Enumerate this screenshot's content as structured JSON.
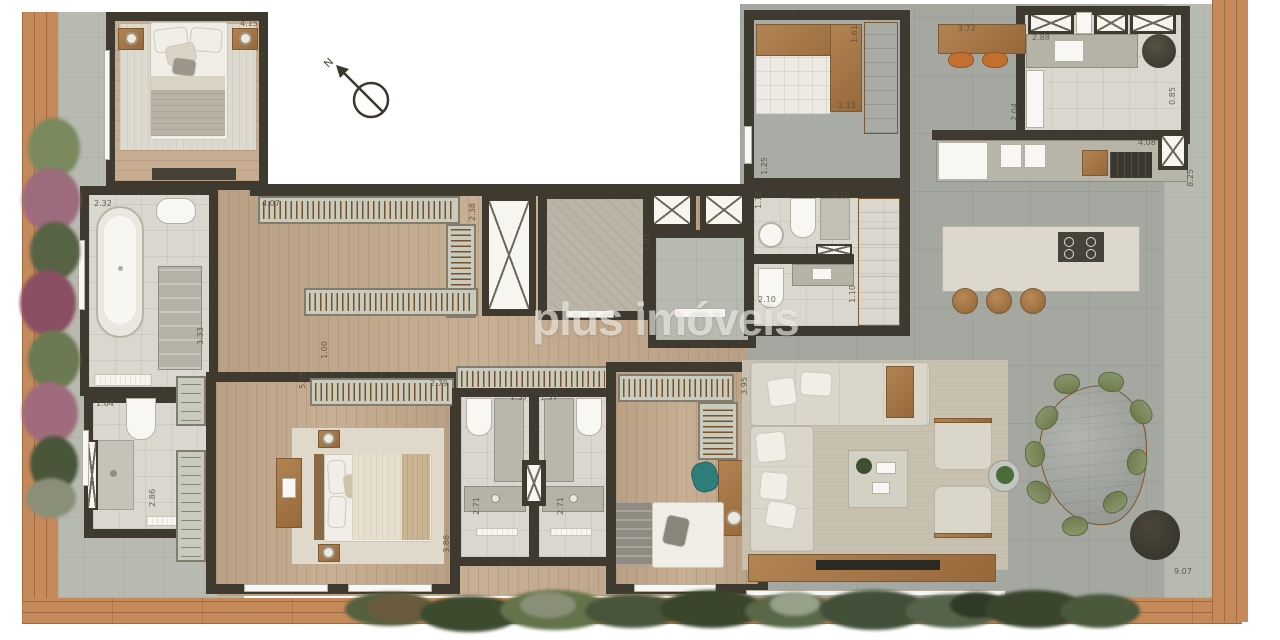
{
  "watermark": {
    "text": "plus imóveis"
  },
  "compass": {
    "label": "N"
  },
  "palette": {
    "wall": "#3f3a2f",
    "deck_wood": "#c5895a",
    "floor_wood": "#c3a98c",
    "floor_concrete": "#a4a8a1",
    "bath_tile": "#dad7ce",
    "cabinet": "#c9cbbd",
    "furniture_wood": "#a87c4e",
    "upholstery": "#dad6ca",
    "dining_chair_green": "#7d8d5b",
    "desk_chair_teal": "#2e7f7c",
    "stool_orange": "#c2702f",
    "watermark_white": "#f8f7f2"
  },
  "dimension_labels": [
    {
      "text": "4.15",
      "x": 240,
      "y": 20,
      "vertical": false
    },
    {
      "text": "2.32",
      "x": 94,
      "y": 200,
      "vertical": false
    },
    {
      "text": "3.33",
      "x": 192,
      "y": 332,
      "vertical": true
    },
    {
      "text": "1.64",
      "x": 96,
      "y": 400,
      "vertical": false
    },
    {
      "text": "2.86",
      "x": 144,
      "y": 494,
      "vertical": true
    },
    {
      "text": "4.07",
      "x": 262,
      "y": 200,
      "vertical": false
    },
    {
      "text": "2.38",
      "x": 464,
      "y": 208,
      "vertical": true
    },
    {
      "text": "1.00",
      "x": 316,
      "y": 346,
      "vertical": true
    },
    {
      "text": "5.95",
      "x": 294,
      "y": 376,
      "vertical": true
    },
    {
      "text": "2.79",
      "x": 430,
      "y": 380,
      "vertical": false
    },
    {
      "text": "3.86",
      "x": 438,
      "y": 540,
      "vertical": true
    },
    {
      "text": "1.37",
      "x": 510,
      "y": 394,
      "vertical": false
    },
    {
      "text": "1.37",
      "x": 540,
      "y": 394,
      "vertical": false
    },
    {
      "text": "2.71",
      "x": 468,
      "y": 502,
      "vertical": true
    },
    {
      "text": "2.71",
      "x": 552,
      "y": 502,
      "vertical": true
    },
    {
      "text": "3.95",
      "x": 736,
      "y": 382,
      "vertical": true
    },
    {
      "text": "1.81",
      "x": 638,
      "y": 238,
      "vertical": true
    },
    {
      "text": "1.12",
      "x": 750,
      "y": 196,
      "vertical": true
    },
    {
      "text": "2.10",
      "x": 832,
      "y": 192,
      "vertical": false
    },
    {
      "text": "2.10",
      "x": 758,
      "y": 296,
      "vertical": false
    },
    {
      "text": "1.10",
      "x": 844,
      "y": 290,
      "vertical": true
    },
    {
      "text": "1.61",
      "x": 846,
      "y": 30,
      "vertical": true
    },
    {
      "text": "2.13",
      "x": 838,
      "y": 102,
      "vertical": false
    },
    {
      "text": "1.25",
      "x": 756,
      "y": 162,
      "vertical": true
    },
    {
      "text": "3.72",
      "x": 958,
      "y": 25,
      "vertical": false
    },
    {
      "text": "2.88",
      "x": 1032,
      "y": 34,
      "vertical": false
    },
    {
      "text": "2.04",
      "x": 1006,
      "y": 108,
      "vertical": true
    },
    {
      "text": "0.85",
      "x": 1164,
      "y": 92,
      "vertical": true
    },
    {
      "text": "4.08",
      "x": 1138,
      "y": 139,
      "vertical": false
    },
    {
      "text": "8.25",
      "x": 1182,
      "y": 174,
      "vertical": true
    },
    {
      "text": "9.07",
      "x": 1174,
      "y": 568,
      "vertical": false
    }
  ]
}
